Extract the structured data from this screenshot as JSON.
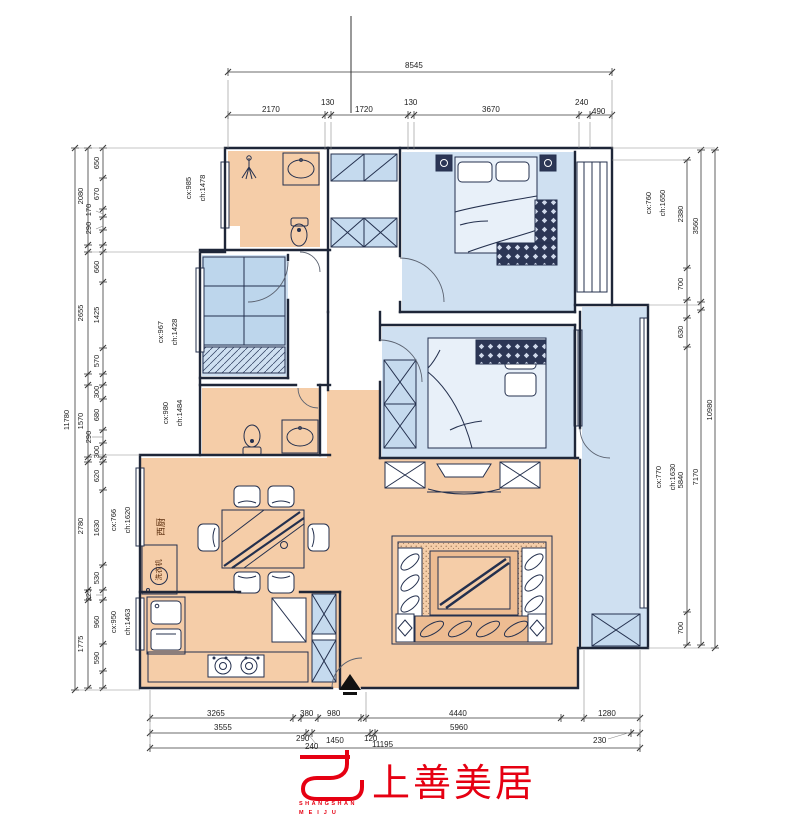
{
  "colors": {
    "accent_red": "#e60012",
    "room_warm": "#f5cda8",
    "room_cool": "#cfe0f1",
    "line_dark": "#1e2638"
  },
  "dims": {
    "top_total": "8545",
    "top": [
      "2170",
      "130",
      "1720",
      "130",
      "3670",
      "240",
      "490"
    ],
    "left_total": "11780",
    "left_l2": [
      "2080",
      "2655",
      "1570",
      "2780",
      "1775"
    ],
    "left_l3": [
      "650",
      "670",
      "170",
      "290",
      "660",
      "1425",
      "570",
      "300",
      "680",
      "290",
      "300",
      "620",
      "1630",
      "530",
      "225",
      "960",
      "590"
    ],
    "right_total": "10980",
    "right_l2": [
      "3560",
      "7170"
    ],
    "right_l3": [
      "2380",
      "700",
      "630",
      "5840",
      "700"
    ],
    "bottom_r1": [
      "3265",
      "380",
      "980",
      "4440",
      "1280"
    ],
    "bottom_r2": [
      "3555",
      "290",
      "1450",
      "120",
      "5960",
      "230"
    ],
    "bottom_extra": "240",
    "bottom_total": "11195"
  },
  "rooms": [
    {
      "cx": "cx:985",
      "ch": "ch:1478"
    },
    {
      "cx": "cx:967",
      "ch": "ch:1428"
    },
    {
      "cx": "cx:980",
      "ch": "ch:1484"
    },
    {
      "cx": "cx:766",
      "ch": "ch:1620"
    },
    {
      "cx": "cx:950",
      "ch": "ch:1463"
    },
    {
      "cx": "cx:760",
      "ch": "ch:1650"
    },
    {
      "cx": "cx:770",
      "ch": "ch:1630"
    }
  ],
  "annotations": {
    "west_kitchen": "西厨",
    "washing_machine": "洗衣机"
  },
  "logo": {
    "cn": "上善美居",
    "en1": "SHANGSHAN",
    "en2": "MEIJU"
  }
}
